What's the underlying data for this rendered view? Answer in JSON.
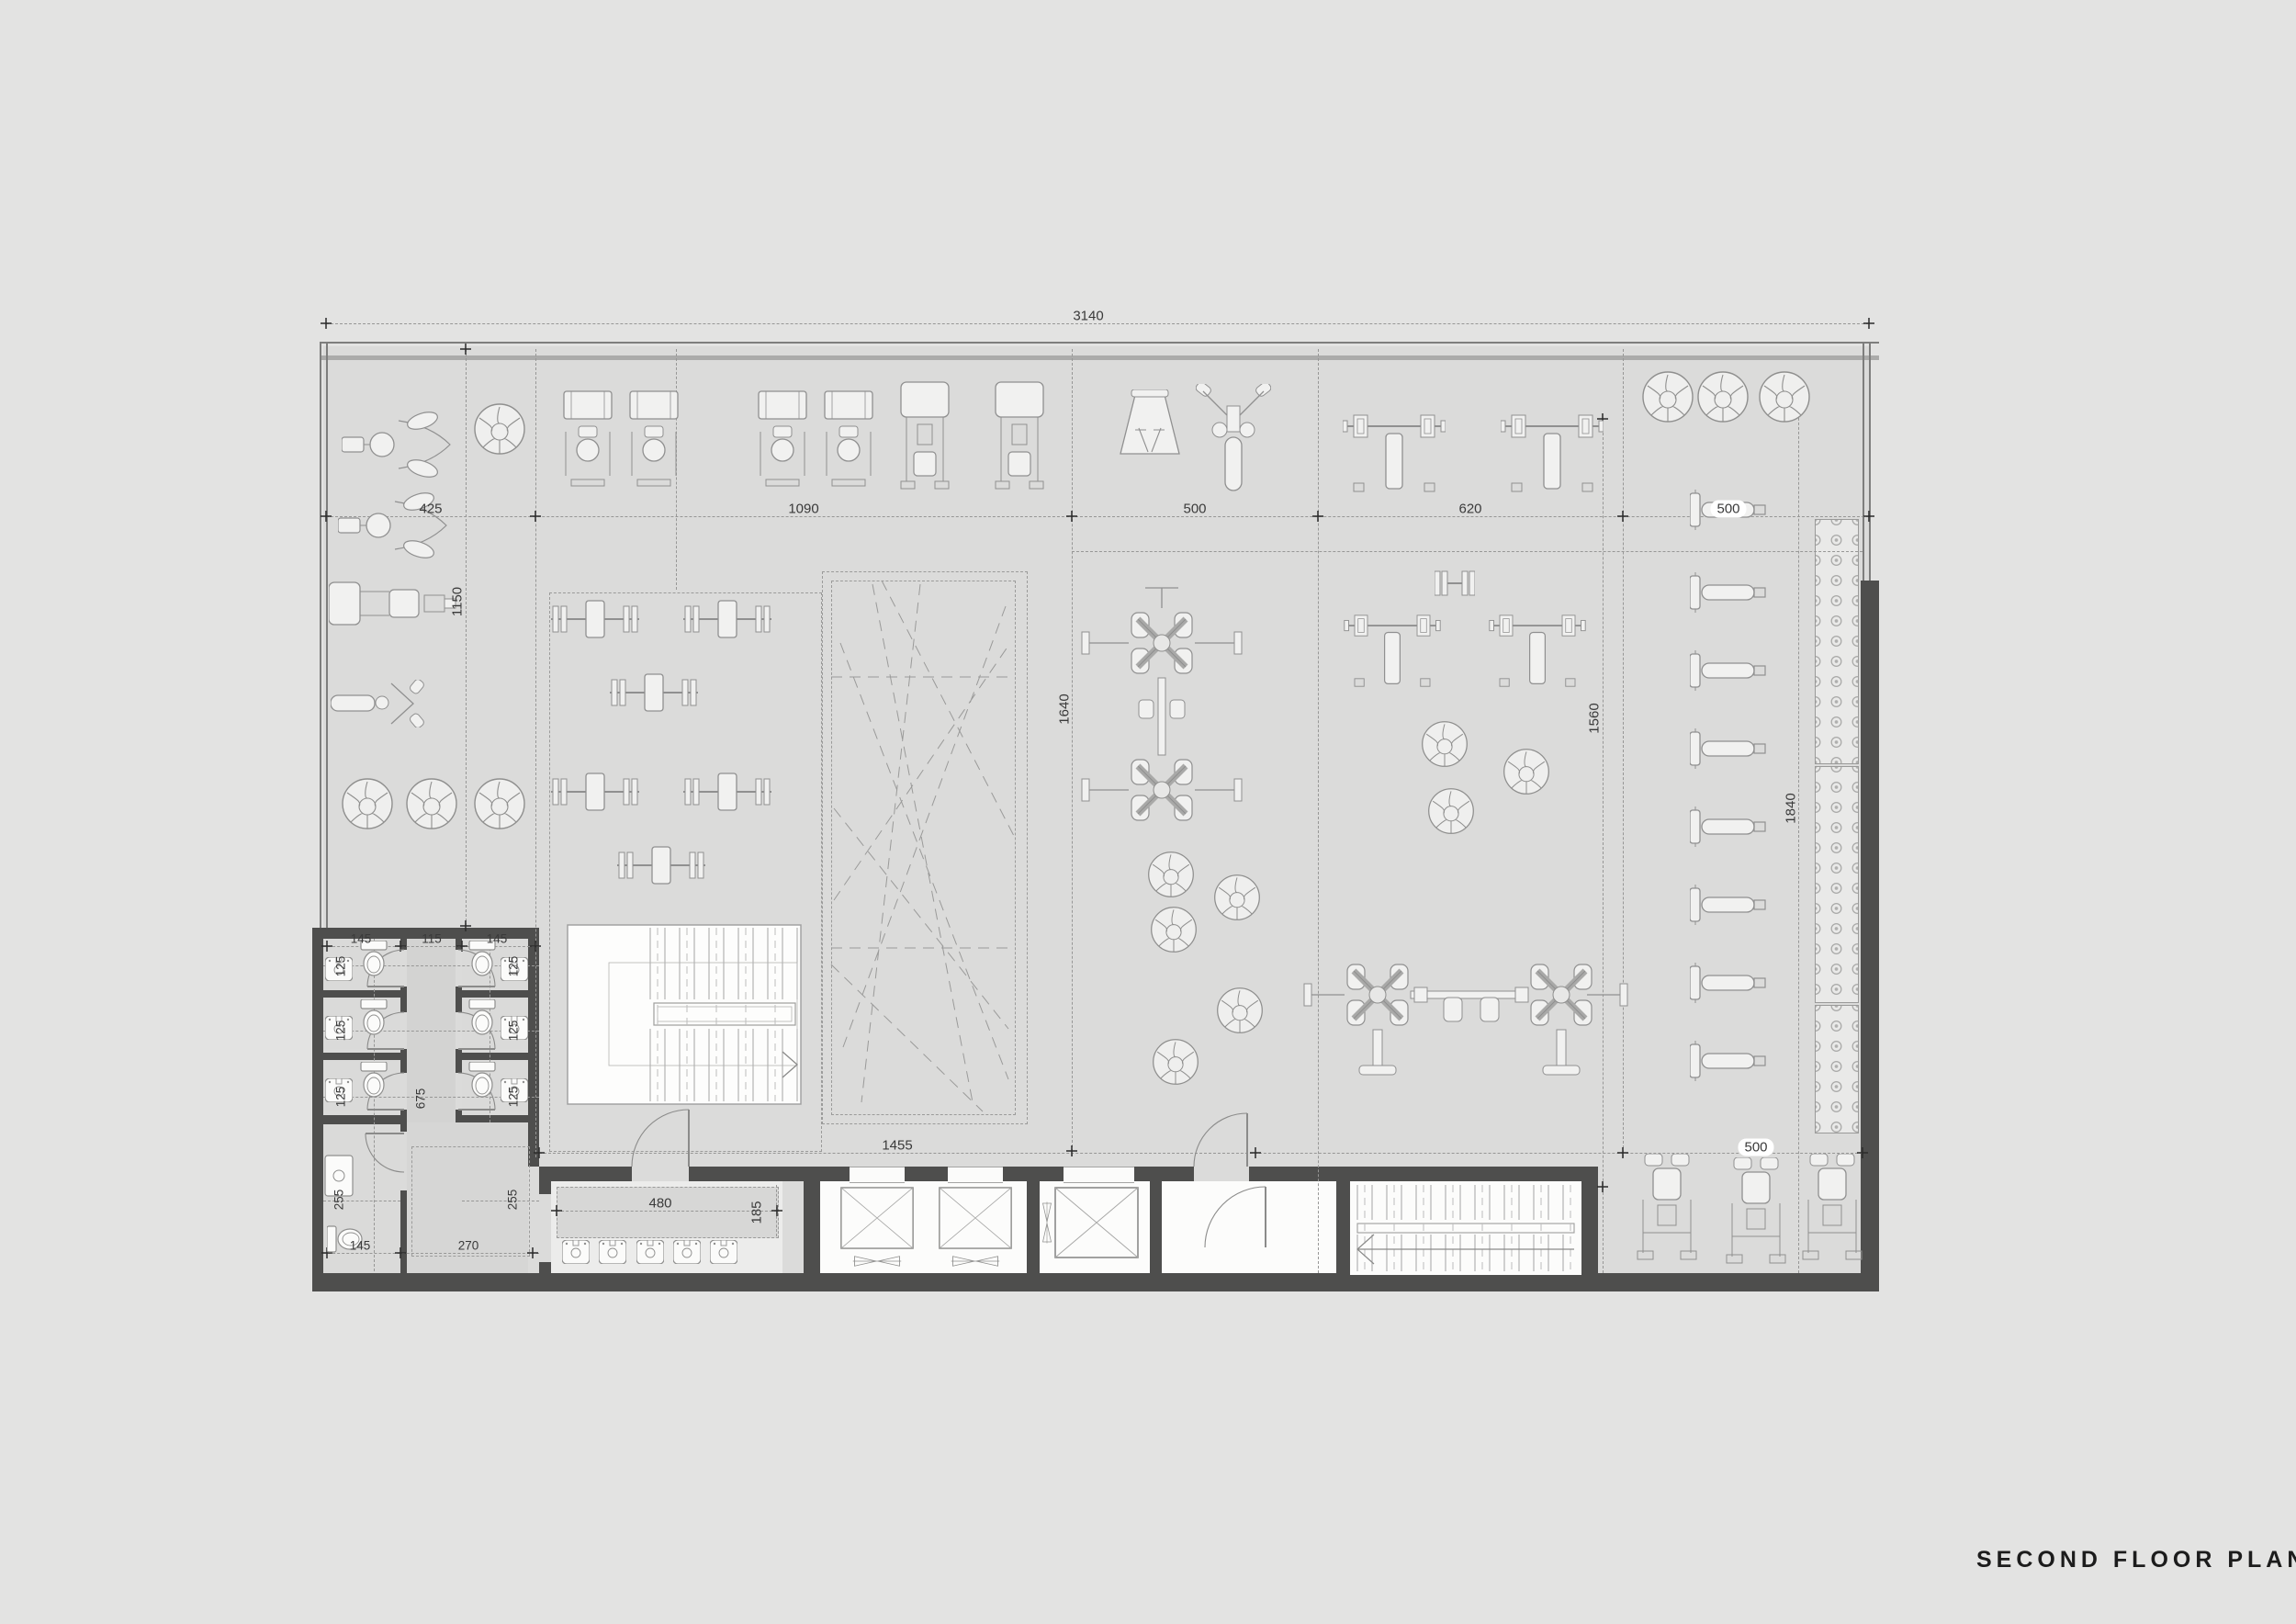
{
  "title": "SECOND FLOOR PLAN",
  "dims": {
    "overall": "3140",
    "c425": "425",
    "c1090": "1090",
    "c500": "500",
    "c620": "620",
    "c500r": "500",
    "v1150": "1150",
    "v1640": "1640",
    "v1560": "1560",
    "v1840": "1840",
    "b1455": "1455",
    "b500": "500",
    "van480": "480",
    "van185": "185",
    "wc145": "145",
    "wc115": "115",
    "wc125": "125",
    "wc675": "675",
    "wc255": "255",
    "wc270": "270"
  },
  "colors": {
    "page": "#e3e3e2",
    "floor": "#dbdbda",
    "wall_dark": "#4e4e4d",
    "line": "#9a9a99",
    "room_white": "#fcfcfb",
    "dim_text": "#3a3a3a"
  },
  "equipment": {
    "exercise_balls": 15,
    "flat_barbell_benches": 6,
    "adjustable_benches": 8,
    "bench_press_racks": 4,
    "weight_stack_machines": 4,
    "leg_press_sleds": 2,
    "pec_deck_machines": 2,
    "dip_station": 1,
    "t_bar_rows": 2,
    "plate_loaded_leg_press": 1,
    "hack_squat_machines": 3,
    "cable_crossover_stations": 2,
    "dumbbell_rack_sections": 3,
    "elevator_cars": 3,
    "staircases": 2,
    "toilets": 7,
    "stall_sinks": 6,
    "vanity_sinks": 5
  }
}
